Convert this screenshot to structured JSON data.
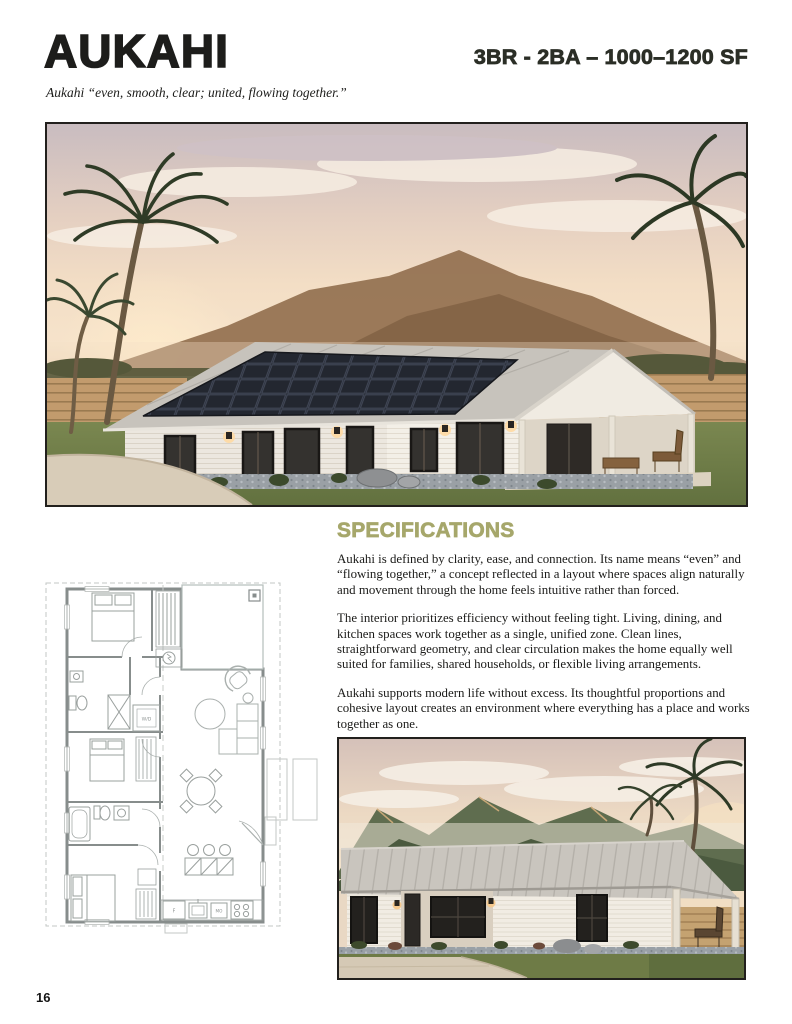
{
  "header": {
    "title": "AUKAHI",
    "tagline": "Aukahi “even, smooth, clear; united, flowing together.”",
    "spec_line": "3BR - 2BA – 1000–1200 SF"
  },
  "specifications": {
    "heading": "SPECIFICATIONS",
    "paragraphs": [
      "Aukahi is defined by clarity, ease, and connection. Its name means “even” and “flowing together,” a concept reflected in a layout where spaces align naturally and movement through the home feels intuitive rather than forced.",
      "The interior prioritizes efficiency without feeling tight. Living, dining, and kitchen spaces work together as a single, unified zone. Clean lines, straightforward geometry, and clear circulation makes the home equally well suited for families, shared households, or flexible living arrangements.",
      "Aukahi supports modern life without excess. Its thoughtful proportions and cohesive layout creates an environment where everything has a place and works together as one."
    ]
  },
  "floor_plan": {
    "washer_dryer_label": "W/D",
    "fridge_label": "F",
    "microwave_label": "MO"
  },
  "images": {
    "main_rendering_alt": "Exterior rendering of the Aukahi single-story home at sunset with a solar-panel roof, palm trees, lawn and mountains behind",
    "secondary_rendering_alt": "Front exterior rendering of the Aukahi home with metal roof, covered porch and green mountains behind"
  },
  "page": {
    "number": "16"
  },
  "colors": {
    "accent_olive": "#a6a76b",
    "spec_text": "#2b2e26"
  }
}
